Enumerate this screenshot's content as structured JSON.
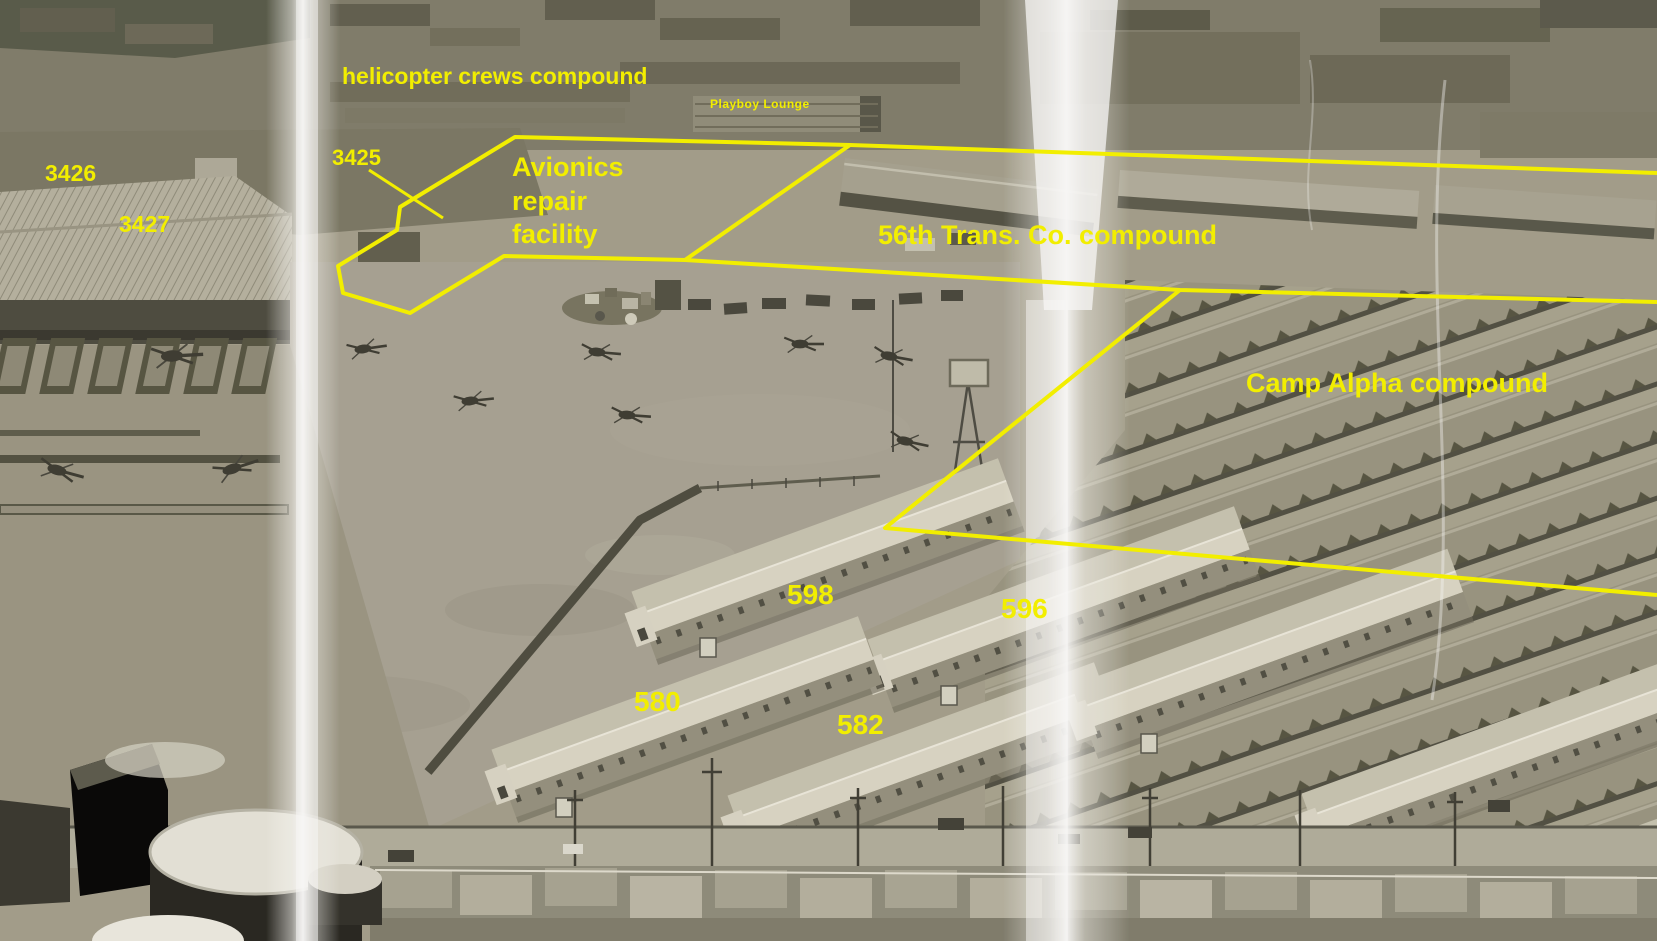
{
  "image": {
    "kind": "annotated aerial photograph",
    "scene": "military base aerial view with yellow hand-drawn compound outlines and labels"
  },
  "annotations": {
    "color": "#f2ee00",
    "labels": {
      "helicopter_crews": "helicopter crews compound",
      "playboy_lounge": "Playboy Lounge",
      "building_3426": "3426",
      "building_3427": "3427",
      "building_3425": "3425",
      "avionics_line1": "Avionics",
      "avionics_line2": "repair",
      "avionics_line3": "facility",
      "trans_co": "56th Trans. Co. compound",
      "camp_alpha": "Camp Alpha compound",
      "building_598": "598",
      "building_596": "596",
      "building_580": "580",
      "building_582": "582"
    }
  }
}
